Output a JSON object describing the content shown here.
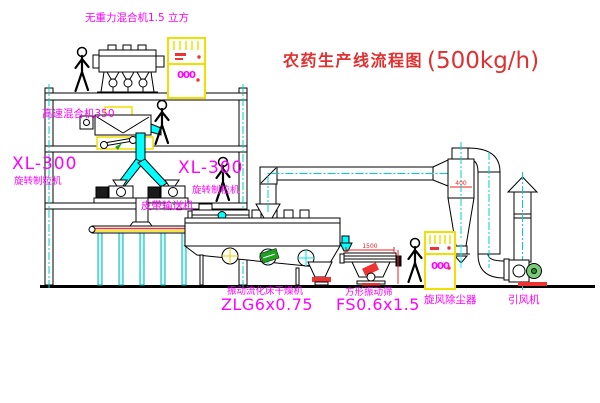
{
  "title": {
    "name": "农药生产线流程图",
    "capacity": "(500kg/h)"
  },
  "equipment_labels": {
    "gravity_mixer": "无重力混合机1.5 立方",
    "high_speed_mixer": "高速混合机350",
    "granulator_left": {
      "model": "XL-300",
      "name": "旋转制粒机"
    },
    "granulator_mid": {
      "model": "XL-300",
      "name": "旋转制粒机"
    },
    "belt_conveyor": "皮带输送机",
    "fluid_bed_dryer": {
      "name": "振动流化床干燥机",
      "model": "ZLG6x0.75"
    },
    "vibrating_screen": {
      "name": "方形振动筛",
      "model": "FS0.6x1.5"
    },
    "cyclone": "旋风除尘器",
    "induced_draft_fan": "引风机"
  },
  "dimensions": {
    "screen_length": "1500",
    "cyclone_diameter": "400"
  },
  "control_cabinet": {
    "display": "000"
  },
  "colors": {
    "label_magenta": "#FF00FF",
    "title_red": "#E03030",
    "dim_red": "#EE2222",
    "centerline_cyan": "#00CFCF",
    "chute_cyan": "#00FFFF",
    "cabinet_yellow": "#F0E000",
    "machine_green": "#1FA01F"
  }
}
